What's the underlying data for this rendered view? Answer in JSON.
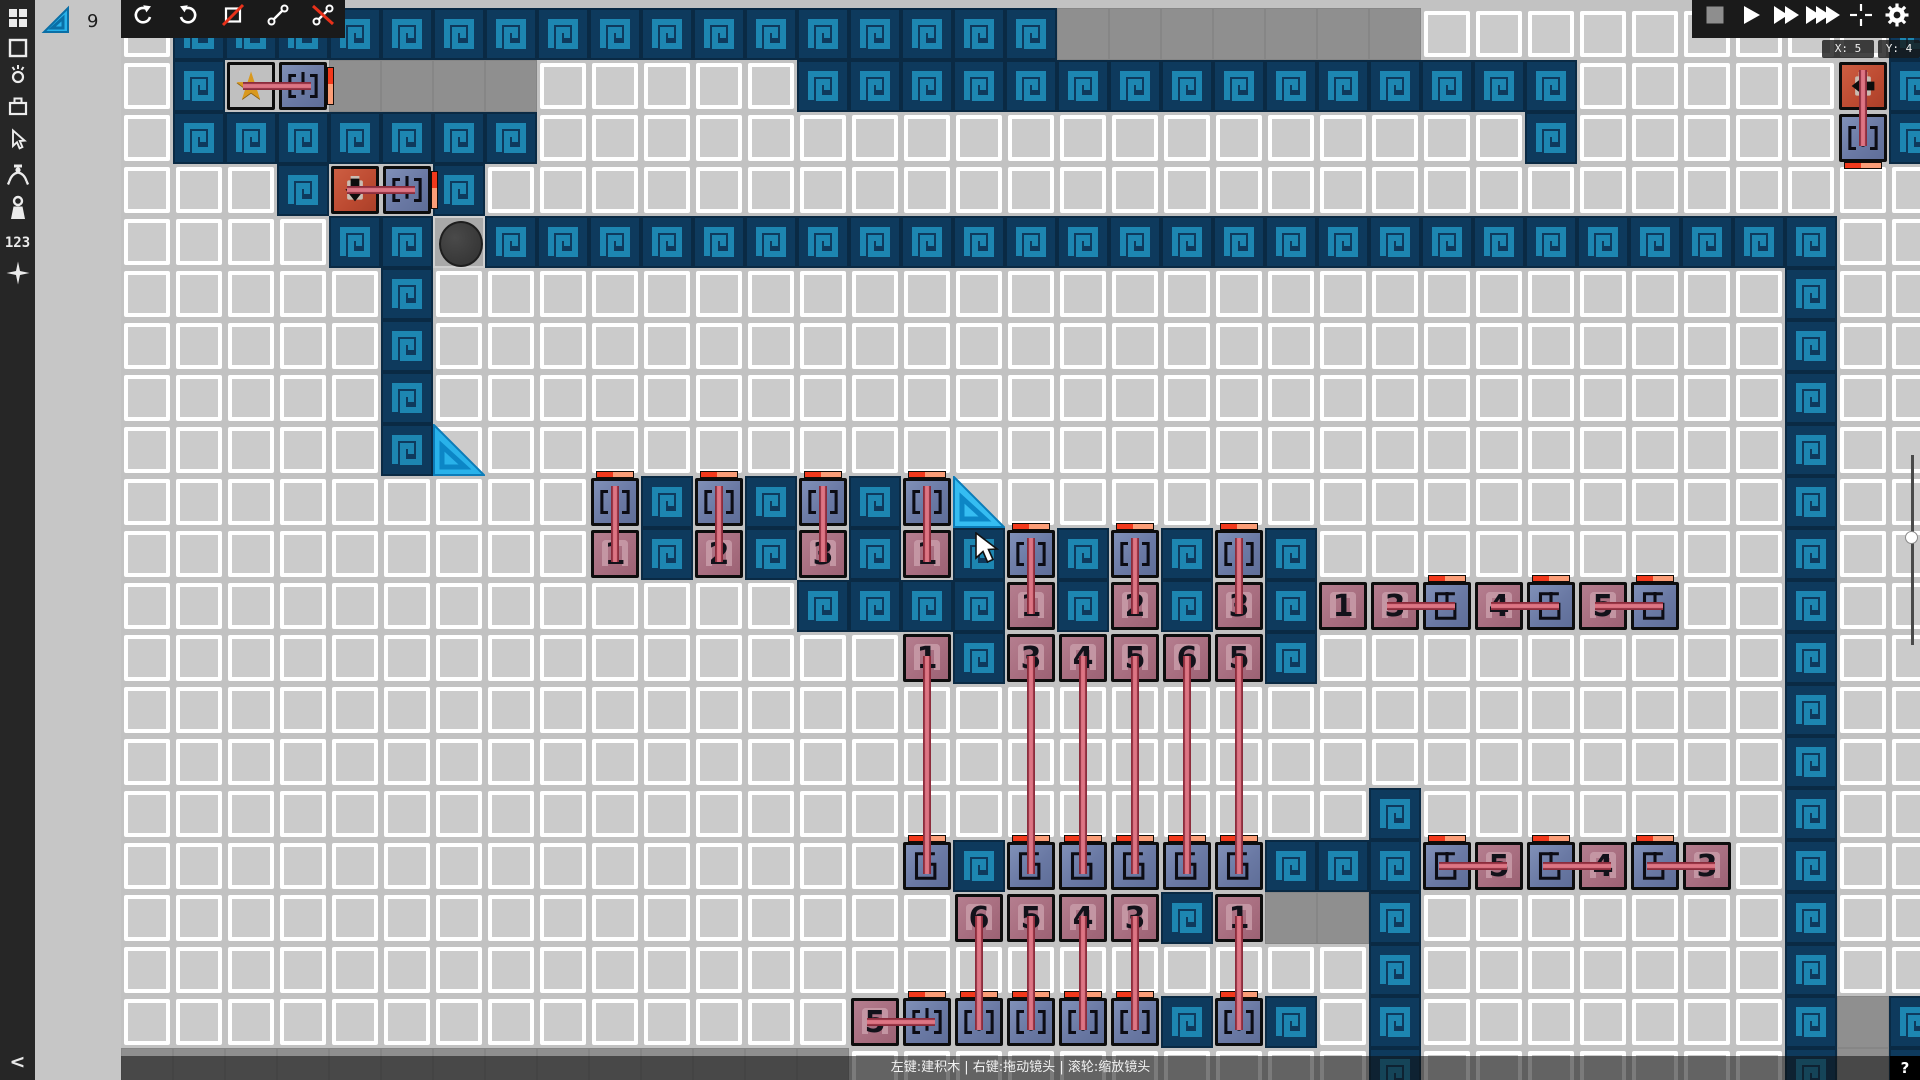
{
  "ui": {
    "sidebar": {
      "icons": [
        {
          "name": "apps-grid-icon"
        },
        {
          "name": "square-tool-icon"
        },
        {
          "name": "grab-tool-icon"
        },
        {
          "name": "box-tool-icon"
        },
        {
          "name": "cursor-tool-icon"
        },
        {
          "name": "claw-tool-icon"
        },
        {
          "name": "weight-tool-icon"
        },
        {
          "name": "numbers-tool-icon",
          "label": "123"
        },
        {
          "name": "sparkle-tool-icon"
        }
      ],
      "collapse_label": "<"
    },
    "panel": {
      "selected_item_icon": "slope-tile-icon",
      "selected_item_count": "9"
    },
    "toolbar_left": [
      {
        "name": "undo-button",
        "glyph": "undo"
      },
      {
        "name": "redo-button",
        "glyph": "redo"
      },
      {
        "name": "rect-delete-button",
        "glyph": "rect-slash"
      },
      {
        "name": "link-button",
        "glyph": "link"
      },
      {
        "name": "unlink-button",
        "glyph": "unlink"
      }
    ],
    "toolbar_right": [
      {
        "name": "stop-button",
        "glyph": "stop"
      },
      {
        "name": "play-button",
        "glyph": "play"
      },
      {
        "name": "fast-forward-button",
        "glyph": "ff"
      },
      {
        "name": "fastest-forward-button",
        "glyph": "fff"
      },
      {
        "name": "center-camera-button",
        "glyph": "crosshair"
      },
      {
        "name": "settings-button",
        "glyph": "gear"
      }
    ],
    "coords": {
      "x": "X: 5",
      "y": "Y: 4"
    },
    "statusbar": {
      "hint": "左键:建积木 | 右键:拖动镜头 | 滚轮:缩放镜头",
      "help": "?"
    }
  },
  "colors": {
    "wall_bg": "#0e3a5d",
    "wall_spiral": "#1d86b1",
    "wall_edge": "#0a2a44",
    "block_blue": "#6a79a4",
    "block_pink": "#a86e80",
    "block_red": "#bc4a31",
    "rod": "#dd7584",
    "cap_red": "#f2391c",
    "cap_salmon": "#fb9d77",
    "slope_cyan": "#29b2ea",
    "star_gold": "#d9991f",
    "ball": "#3c3c3c",
    "cell": "#cbcbcb",
    "gray_cell": "#8f8f8f"
  },
  "level": {
    "grid": {
      "tile": 52,
      "ox": 121,
      "oy": 8,
      "cols": 35,
      "rows": 21
    },
    "walls": [
      [
        1,
        0,
        17,
        0
      ],
      [
        34,
        0,
        34,
        2
      ],
      [
        1,
        1,
        1,
        1
      ],
      [
        13,
        1,
        27,
        1
      ],
      [
        1,
        2,
        7,
        2
      ],
      [
        27,
        2,
        27,
        2
      ],
      [
        3,
        3,
        3,
        3
      ],
      [
        6,
        3,
        6,
        3
      ],
      [
        4,
        4,
        5,
        4
      ],
      [
        7,
        4,
        31,
        4
      ],
      [
        5,
        5,
        5,
        8
      ],
      [
        10,
        9,
        10,
        9
      ],
      [
        12,
        9,
        12,
        9
      ],
      [
        14,
        9,
        14,
        9
      ],
      [
        10,
        10,
        10,
        10
      ],
      [
        12,
        10,
        12,
        10
      ],
      [
        14,
        10,
        14,
        10
      ],
      [
        16,
        10,
        16,
        10
      ],
      [
        18,
        10,
        18,
        10
      ],
      [
        20,
        10,
        20,
        10
      ],
      [
        22,
        10,
        22,
        12
      ],
      [
        13,
        11,
        16,
        11
      ],
      [
        18,
        11,
        18,
        11
      ],
      [
        20,
        11,
        20,
        11
      ],
      [
        16,
        12,
        16,
        12
      ],
      [
        32,
        4,
        32,
        20
      ],
      [
        24,
        15,
        24,
        20
      ],
      [
        16,
        16,
        16,
        16
      ],
      [
        22,
        16,
        23,
        16
      ],
      [
        20,
        17,
        20,
        17
      ],
      [
        20,
        19,
        20,
        19
      ],
      [
        22,
        19,
        22,
        19
      ],
      [
        34,
        19,
        34,
        20
      ]
    ],
    "gray_regions": [
      [
        18,
        0,
        24,
        0
      ],
      [
        4,
        1,
        7,
        1
      ],
      [
        22,
        17,
        23,
        17
      ],
      [
        0,
        20,
        13,
        20
      ],
      [
        33,
        19,
        33,
        20
      ]
    ],
    "ball": {
      "c": 6,
      "r": 4
    },
    "slopes": [
      {
        "c": 6,
        "r": 8,
        "hover": false
      },
      {
        "c": 16,
        "r": 9,
        "hover": true
      }
    ],
    "blocks": [
      {
        "k": "star",
        "c": 2,
        "r": 1
      },
      {
        "k": "clamp",
        "c": 3,
        "r": 1,
        "cap": "right"
      },
      {
        "k": "arrow",
        "c": 4,
        "r": 3,
        "dir": "down"
      },
      {
        "k": "clamp",
        "c": 5,
        "r": 3,
        "cap": "right"
      },
      {
        "k": "arrow",
        "c": 33,
        "r": 1,
        "dir": "left"
      },
      {
        "k": "clamp",
        "c": 33,
        "r": 2,
        "cap": "bottom"
      },
      {
        "k": "clamp",
        "c": 9,
        "r": 9,
        "cap": "top"
      },
      {
        "k": "clamp",
        "c": 11,
        "r": 9,
        "cap": "top"
      },
      {
        "k": "clamp",
        "c": 13,
        "r": 9,
        "cap": "top"
      },
      {
        "k": "clamp",
        "c": 15,
        "r": 9,
        "cap": "top"
      },
      {
        "k": "num",
        "c": 9,
        "r": 10,
        "n": "1"
      },
      {
        "k": "num",
        "c": 11,
        "r": 10,
        "n": "2"
      },
      {
        "k": "num",
        "c": 13,
        "r": 10,
        "n": "3"
      },
      {
        "k": "num",
        "c": 15,
        "r": 10,
        "n": "1"
      },
      {
        "k": "clamp",
        "c": 17,
        "r": 10,
        "cap": "top"
      },
      {
        "k": "clamp",
        "c": 19,
        "r": 10,
        "cap": "top"
      },
      {
        "k": "clamp",
        "c": 21,
        "r": 10,
        "cap": "top"
      },
      {
        "k": "num",
        "c": 17,
        "r": 11,
        "n": "1"
      },
      {
        "k": "num",
        "c": 19,
        "r": 11,
        "n": "2"
      },
      {
        "k": "num",
        "c": 21,
        "r": 11,
        "n": "3"
      },
      {
        "k": "num",
        "c": 23,
        "r": 11,
        "n": "1"
      },
      {
        "k": "num",
        "c": 24,
        "r": 11,
        "n": "3"
      },
      {
        "k": "socket",
        "c": 25,
        "r": 11,
        "cap": "top"
      },
      {
        "k": "num",
        "c": 26,
        "r": 11,
        "n": "4"
      },
      {
        "k": "socket",
        "c": 27,
        "r": 11,
        "cap": "top"
      },
      {
        "k": "num",
        "c": 28,
        "r": 11,
        "n": "5"
      },
      {
        "k": "socket",
        "c": 29,
        "r": 11,
        "cap": "top"
      },
      {
        "k": "num",
        "c": 15,
        "r": 12,
        "n": "1"
      },
      {
        "k": "num",
        "c": 17,
        "r": 12,
        "n": "3"
      },
      {
        "k": "num",
        "c": 18,
        "r": 12,
        "n": "4"
      },
      {
        "k": "num",
        "c": 19,
        "r": 12,
        "n": "5"
      },
      {
        "k": "num",
        "c": 20,
        "r": 12,
        "n": "6"
      },
      {
        "k": "num",
        "c": 21,
        "r": 12,
        "n": "5"
      },
      {
        "k": "socket",
        "c": 15,
        "r": 16,
        "cap": "top"
      },
      {
        "k": "socket",
        "c": 17,
        "r": 16,
        "cap": "top"
      },
      {
        "k": "socket",
        "c": 18,
        "r": 16,
        "cap": "top"
      },
      {
        "k": "socket",
        "c": 19,
        "r": 16,
        "cap": "top"
      },
      {
        "k": "socket",
        "c": 20,
        "r": 16,
        "cap": "top"
      },
      {
        "k": "socket",
        "c": 21,
        "r": 16,
        "cap": "top"
      },
      {
        "k": "socket",
        "c": 25,
        "r": 16,
        "cap": "top"
      },
      {
        "k": "num",
        "c": 26,
        "r": 16,
        "n": "5"
      },
      {
        "k": "socket",
        "c": 27,
        "r": 16,
        "cap": "top"
      },
      {
        "k": "num",
        "c": 28,
        "r": 16,
        "n": "4"
      },
      {
        "k": "socket",
        "c": 29,
        "r": 16,
        "cap": "top"
      },
      {
        "k": "num",
        "c": 30,
        "r": 16,
        "n": "3"
      },
      {
        "k": "num",
        "c": 16,
        "r": 17,
        "n": "6"
      },
      {
        "k": "num",
        "c": 17,
        "r": 17,
        "n": "5"
      },
      {
        "k": "num",
        "c": 18,
        "r": 17,
        "n": "4"
      },
      {
        "k": "num",
        "c": 19,
        "r": 17,
        "n": "3"
      },
      {
        "k": "num",
        "c": 21,
        "r": 17,
        "n": "1"
      },
      {
        "k": "num",
        "c": 14,
        "r": 19,
        "n": "5"
      },
      {
        "k": "clamp",
        "c": 15,
        "r": 19,
        "cap": "top"
      },
      {
        "k": "clamp",
        "c": 16,
        "r": 19,
        "cap": "top"
      },
      {
        "k": "clamp",
        "c": 17,
        "r": 19,
        "cap": "top"
      },
      {
        "k": "clamp",
        "c": 18,
        "r": 19,
        "cap": "top"
      },
      {
        "k": "clamp",
        "c": 19,
        "r": 19,
        "cap": "top"
      },
      {
        "k": "clamp",
        "c": 21,
        "r": 19,
        "cap": "top"
      }
    ],
    "rods": [
      [
        2,
        1,
        3,
        1
      ],
      [
        4,
        3,
        5,
        3
      ],
      [
        33,
        1,
        33,
        2
      ],
      [
        9,
        9,
        9,
        10
      ],
      [
        11,
        9,
        11,
        10
      ],
      [
        13,
        9,
        13,
        10
      ],
      [
        15,
        9,
        15,
        10
      ],
      [
        17,
        10,
        17,
        11
      ],
      [
        19,
        10,
        19,
        11
      ],
      [
        21,
        10,
        21,
        11
      ],
      [
        24,
        11,
        25,
        11
      ],
      [
        26,
        11,
        27,
        11
      ],
      [
        28,
        11,
        29,
        11
      ],
      [
        15,
        12,
        15,
        16
      ],
      [
        17,
        12,
        17,
        16
      ],
      [
        18,
        12,
        18,
        16
      ],
      [
        19,
        12,
        19,
        16
      ],
      [
        20,
        12,
        20,
        16
      ],
      [
        21,
        12,
        21,
        16
      ],
      [
        16,
        17,
        16,
        19
      ],
      [
        17,
        17,
        17,
        19
      ],
      [
        18,
        17,
        18,
        19
      ],
      [
        19,
        17,
        19,
        19
      ],
      [
        21,
        17,
        21,
        19
      ],
      [
        14,
        19,
        15,
        19
      ],
      [
        25,
        16,
        26,
        16
      ],
      [
        27,
        16,
        28,
        16
      ],
      [
        29,
        16,
        30,
        16
      ]
    ],
    "cursor": {
      "x": 974,
      "y": 532
    }
  }
}
